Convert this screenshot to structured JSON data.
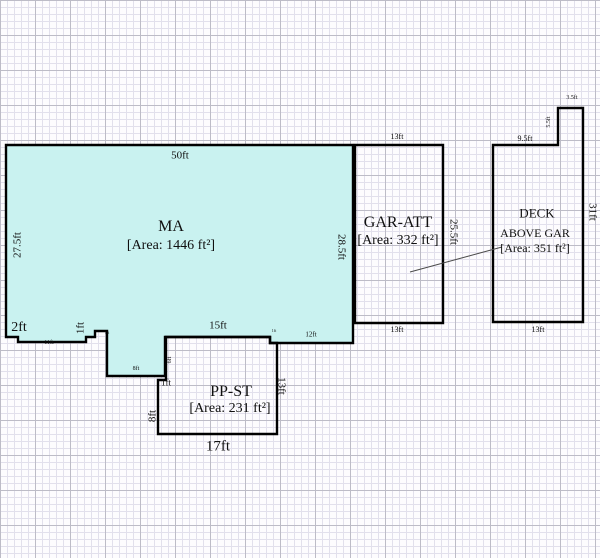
{
  "sketch": {
    "colors": {
      "background": "#fdfcfe",
      "grid_minor": "#dedcea",
      "grid_major": "#b3b1be",
      "outline": "#000000",
      "main_area_fill": "#c9f2f0"
    },
    "rooms": [
      {
        "name": "MA",
        "area_sqft": 1446
      },
      {
        "name": "GAR-ATT",
        "area_sqft": 332
      },
      {
        "name": "PP-ST",
        "area_sqft": 231
      },
      {
        "name": "DECK ABOVE GAR",
        "area_sqft": 351
      }
    ],
    "labels": [
      {
        "name": "ma-dim-top",
        "text": "50ft",
        "x": 180,
        "y": 156,
        "size": 11,
        "rot": 0
      },
      {
        "name": "ma-dim-left",
        "text": "27.5ft",
        "x": 18,
        "y": 245,
        "size": 11,
        "rot": -90
      },
      {
        "name": "ma-room-name",
        "text": "MA",
        "x": 171,
        "y": 227,
        "size": 16,
        "rot": 0
      },
      {
        "name": "ma-area-label",
        "text": "[Area: 1446 ft²]",
        "x": 171,
        "y": 246,
        "size": 14,
        "rot": 0
      },
      {
        "name": "ma-dim-2ft",
        "text": "2ft",
        "x": 19,
        "y": 328,
        "size": 14,
        "rot": 0
      },
      {
        "name": "ma-dim-11ft",
        "text": "11ft",
        "x": 49,
        "y": 343,
        "size": 6,
        "rot": 0
      },
      {
        "name": "ma-dim-1ft-left",
        "text": "1ft",
        "x": 81,
        "y": 328,
        "size": 11,
        "rot": -90
      },
      {
        "name": "ma-dim-step-tiny",
        "text": "1ft",
        "x": 107,
        "y": 333,
        "size": 4,
        "rot": 0
      },
      {
        "name": "ma-dim-8ft",
        "text": "8ft",
        "x": 136,
        "y": 369,
        "size": 6,
        "rot": 0
      },
      {
        "name": "ma-dim-15ft",
        "text": "15ft",
        "x": 218,
        "y": 326,
        "size": 11,
        "rot": 0
      },
      {
        "name": "ma-dim-step2-tiny",
        "text": "1ft",
        "x": 274,
        "y": 331,
        "size": 4,
        "rot": 0
      },
      {
        "name": "ma-dim-12ft",
        "text": "12ft",
        "x": 311,
        "y": 335,
        "size": 7,
        "rot": 0
      },
      {
        "name": "ma-dim-right",
        "text": "28.5ft",
        "x": 341,
        "y": 247,
        "size": 11,
        "rot": 90
      },
      {
        "name": "gar-dim-top",
        "text": "13ft",
        "x": 397,
        "y": 137,
        "size": 8,
        "rot": 0
      },
      {
        "name": "gar-room-name",
        "text": "GAR-ATT",
        "x": 398,
        "y": 223,
        "size": 16,
        "rot": 0
      },
      {
        "name": "gar-area-label",
        "text": "[Area: 332 ft²]",
        "x": 398,
        "y": 241,
        "size": 14,
        "rot": 0
      },
      {
        "name": "gar-dim-right",
        "text": "25.5ft",
        "x": 453,
        "y": 232,
        "size": 11,
        "rot": 90
      },
      {
        "name": "gar-dim-bottom",
        "text": "13ft",
        "x": 397,
        "y": 330,
        "size": 8,
        "rot": 0
      },
      {
        "name": "deck-dim-step-top",
        "text": "3.5ft",
        "x": 572,
        "y": 98,
        "size": 6,
        "rot": 0
      },
      {
        "name": "deck-dim-step-left",
        "text": "5.5ft",
        "x": 549,
        "y": 122,
        "size": 6,
        "rot": -90
      },
      {
        "name": "deck-dim-top",
        "text": "9.5ft",
        "x": 525,
        "y": 139,
        "size": 8,
        "rot": 0
      },
      {
        "name": "deck-dim-right",
        "text": "31ft",
        "x": 592,
        "y": 212,
        "size": 11,
        "rot": 90
      },
      {
        "name": "deck-room-name",
        "text": "DECK",
        "x": 537,
        "y": 213,
        "size": 13,
        "rot": 0
      },
      {
        "name": "deck-room-name-2",
        "text": "ABOVE GAR",
        "x": 535,
        "y": 233,
        "size": 12,
        "rot": 0
      },
      {
        "name": "deck-area-label",
        "text": "[Area: 351 ft²]",
        "x": 535,
        "y": 248,
        "size": 12,
        "rot": 0
      },
      {
        "name": "deck-dim-bottom",
        "text": "13ft",
        "x": 538,
        "y": 330,
        "size": 8,
        "rot": 0
      },
      {
        "name": "ppst-dim-6ft",
        "text": "6ft",
        "x": 170,
        "y": 360,
        "size": 6,
        "rot": -90
      },
      {
        "name": "ppst-dim-1ft",
        "text": "1ft",
        "x": 166,
        "y": 383,
        "size": 9,
        "rot": 0
      },
      {
        "name": "ppst-room-name",
        "text": "PP-ST",
        "x": 231,
        "y": 392,
        "size": 16,
        "rot": 0
      },
      {
        "name": "ppst-area-label",
        "text": "[Area: 231 ft²]",
        "x": 230,
        "y": 409,
        "size": 14,
        "rot": 0
      },
      {
        "name": "ppst-dim-left",
        "text": "8ft",
        "x": 153,
        "y": 416,
        "size": 11,
        "rot": -90
      },
      {
        "name": "ppst-dim-right",
        "text": "13ft",
        "x": 281,
        "y": 386,
        "size": 11,
        "rot": 90
      },
      {
        "name": "ppst-dim-bottom",
        "text": "17ft",
        "x": 218,
        "y": 447,
        "size": 15,
        "rot": 0
      }
    ]
  }
}
